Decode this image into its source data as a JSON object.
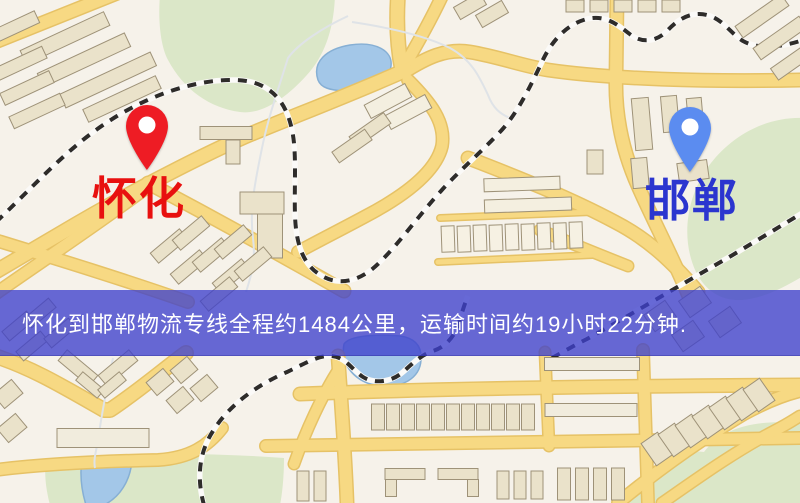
{
  "banner": {
    "text": "怀化到邯郸物流专线全程约1484公里，运输时间约19小时22分钟.",
    "bg": "rgba(62,64,204,0.78)",
    "text_color": "#ffffff"
  },
  "markers": {
    "huaihua": {
      "label": "怀化",
      "pin_color": "#ee1c24",
      "label_color": "#e8100f"
    },
    "handan": {
      "label": "邯郸",
      "pin_color": "#5b8cf0",
      "label_color": "#2b35cf"
    }
  },
  "map": {
    "palette": {
      "land": "#f6f2ea",
      "park": "#dbe7c8",
      "water": "#a3c7e8",
      "water_edge": "#86afd4",
      "creek": "#dfe3e7",
      "road": "#f7d983",
      "road_casing": "#e6c266",
      "rail_dark": "#2e2c2a",
      "rail_light": "#fbfaf8",
      "building": "#eae2ca",
      "building_edge": "#9e9278"
    },
    "parks": [
      {
        "d": "M160,-5 L335,-5 C334,28 325,56 306,76 C286,98 262,115 240,112 C210,108 184,90 168,60 C160,45 158,18 160,-5 Z"
      },
      {
        "d": "M805,118 C762,116 726,140 706,170 C686,200 681,240 696,272 C706,292 722,301 742,300 C766,298 786,286 805,275 Z"
      },
      {
        "d": "M46,461 C120,452 200,452 284,458 C284,478 282,495 280,505 L50,505 C46,490 44,474 46,461 Z"
      },
      {
        "d": "M628,505 C652,468 676,448 704,452 C722,428 756,418 805,424 L805,505 Z"
      }
    ],
    "waters": [
      {
        "d": "M318,80 C312,62 326,49 350,45 C376,41 393,51 391,66 C389,82 368,93 344,91 C330,90 321,88 318,80 Z"
      },
      {
        "d": "M344,344 C340,365 355,382 378,386 C402,389 420,378 421,360 C422,346 415,338 400,336 C380,334 350,335 344,344 Z"
      },
      {
        "d": "M82,458 L132,461 C130,481 120,497 104,505 L86,505 C81,489 80,472 82,458 Z"
      }
    ],
    "creeks": [
      {
        "d": "M348,16 C322,28 298,44 288,58 C278,90 268,118 262,148 C256,178 249,208 253,238 C256,262 251,276 246,292"
      },
      {
        "d": "M113,358 C108,382 102,412 99,434 C97,450 93,458 95,468"
      },
      {
        "d": "M352,22 C392,28 426,36 450,48 C472,60 480,78 488,95 C493,108 500,114 510,118"
      }
    ],
    "roads": [
      {
        "d": "M-5,42 L120,-8",
        "w": 12
      },
      {
        "d": "M398,-5 C396,25 398,50 402,70",
        "w": 13
      },
      {
        "d": "M402,70 C415,48 430,22 443,-6",
        "w": 11
      },
      {
        "d": "M404,72 C426,58 446,48 470,52 C500,57 522,66 548,70 C610,79 706,82 800,80",
        "w": 12
      },
      {
        "d": "M406,70 C352,94 294,116 246,136 C190,161 120,198 58,235 C36,248 14,261 -5,272",
        "w": 13
      },
      {
        "d": "M162,176 C112,214 54,253 -5,294",
        "w": 11
      },
      {
        "d": "M-5,240 C60,260 122,279 188,302",
        "w": 11
      },
      {
        "d": "M148,183 C212,217 274,251 344,291",
        "w": 12
      },
      {
        "d": "M408,80 C430,102 446,122 442,146 C436,172 404,196 366,216 C342,229 318,241 298,252",
        "w": 11
      },
      {
        "d": "M617,-5 L616,78 C615,114 622,150 638,186 C654,222 672,256 688,294",
        "w": 12
      },
      {
        "d": "M468,158 C520,178 570,198 615,222 C650,240 674,264 698,292",
        "w": 12
      },
      {
        "d": "M440,218 L592,212",
        "w": 5
      },
      {
        "d": "M438,262 L592,255",
        "w": 5
      },
      {
        "d": "M-5,356 C32,368 62,386 104,410 L110,410 C140,390 164,369 186,353",
        "w": 13
      },
      {
        "d": "M-5,470 C52,463 112,461 158,460 C190,458 208,446 222,428",
        "w": 11
      },
      {
        "d": "M338,356 C341,400 345,450 347,503",
        "w": 12
      },
      {
        "d": "M300,394 C430,389 610,386 800,385",
        "w": 12
      },
      {
        "d": "M266,446 C440,442 620,440 800,438",
        "w": 11
      },
      {
        "d": "M643,350 L648,503",
        "w": 11
      },
      {
        "d": "M545,352 L549,446",
        "w": 10
      },
      {
        "d": "M618,503 C658,470 700,440 744,414 C764,403 784,395 800,391",
        "w": 11
      },
      {
        "d": "M662,503 C698,478 734,452 774,431 C788,424 795,419 800,416",
        "w": 10
      },
      {
        "d": "M337,372 C322,396 306,430 294,464",
        "w": 10
      },
      {
        "d": "M540,230 C570,243 600,255 628,266",
        "w": 10
      }
    ],
    "railways": [
      {
        "d": "M-4,222 C28,192 60,156 96,130 C140,98 192,79 236,80 C270,81 286,101 292,130 C297,152 294,188 295,215 C296,246 304,266 322,276 C341,287 363,280 381,261 C401,241 420,214 441,191 C459,171 479,154 498,134 C516,116 529,89 541,64 C551,41 567,24 587,19 C607,14 620,27 631,35 C643,44 658,41 668,30 C678,19 692,11 707,15 C723,19 730,33 743,41 C757,49 778,48 800,41"
      },
      {
        "d": "M552,358 C563,352 575,345 587,339 C632,314 682,284 731,256 C756,241 779,227 804,212"
      },
      {
        "d": "M204,505 C197,480 198,454 213,431 C229,405 257,385 287,372 C306,363 319,355 331,356 C346,357 352,370 363,377 C376,385 393,381 403,372 C413,363 421,355 433,351 C445,347 453,338 458,326 C461,316 464,305 468,296"
      }
    ],
    "buildings": [
      {
        "cx": 65,
        "cy": 38,
        "w": 92,
        "h": 15,
        "r": -25
      },
      {
        "cx": 84,
        "cy": 60,
        "w": 96,
        "h": 15,
        "r": -25
      },
      {
        "cx": 108,
        "cy": 80,
        "w": 100,
        "h": 15,
        "r": -25
      },
      {
        "cx": 122,
        "cy": 99,
        "w": 80,
        "h": 14,
        "r": -25
      },
      {
        "cx": 19,
        "cy": 64,
        "w": 56,
        "h": 13,
        "r": -25
      },
      {
        "cx": 27,
        "cy": 88,
        "w": 54,
        "h": 13,
        "r": -25
      },
      {
        "cx": 37,
        "cy": 111,
        "w": 56,
        "h": 13,
        "r": -25
      },
      {
        "cx": 17,
        "cy": 26,
        "w": 44,
        "h": 13,
        "r": -25
      },
      {
        "cx": 226,
        "cy": 133,
        "w": 52,
        "h": 13,
        "r": 0
      },
      {
        "cx": 233,
        "cy": 152,
        "w": 14,
        "h": 24,
        "r": 0
      },
      {
        "cx": 262,
        "cy": 203,
        "w": 44,
        "h": 22,
        "r": 0
      },
      {
        "cx": 270,
        "cy": 236,
        "w": 25,
        "h": 44,
        "r": 0
      },
      {
        "cx": 169,
        "cy": 246,
        "w": 38,
        "h": 13,
        "r": -40
      },
      {
        "cx": 191,
        "cy": 233,
        "w": 38,
        "h": 13,
        "r": -40
      },
      {
        "cx": 189,
        "cy": 267,
        "w": 38,
        "h": 13,
        "r": -40
      },
      {
        "cx": 211,
        "cy": 255,
        "w": 38,
        "h": 13,
        "r": -40
      },
      {
        "cx": 233,
        "cy": 242,
        "w": 38,
        "h": 13,
        "r": -40
      },
      {
        "cx": 231,
        "cy": 276,
        "w": 38,
        "h": 13,
        "r": -40
      },
      {
        "cx": 253,
        "cy": 264,
        "w": 38,
        "h": 13,
        "r": -40
      },
      {
        "cx": 219,
        "cy": 294,
        "w": 38,
        "h": 13,
        "r": -40
      },
      {
        "cx": 388,
        "cy": 101,
        "w": 46,
        "h": 15,
        "r": -28,
        "f": "#f4efe0"
      },
      {
        "cx": 408,
        "cy": 112,
        "w": 46,
        "h": 15,
        "r": -28,
        "f": "#f4efe0"
      },
      {
        "cx": 370,
        "cy": 130,
        "w": 42,
        "h": 13,
        "r": -35
      },
      {
        "cx": 352,
        "cy": 146,
        "w": 40,
        "h": 13,
        "r": -35
      },
      {
        "cx": 470,
        "cy": 6,
        "w": 30,
        "h": 14,
        "r": -30
      },
      {
        "cx": 492,
        "cy": 14,
        "w": 30,
        "h": 14,
        "r": -30
      },
      {
        "cx": 575,
        "cy": 6,
        "w": 18,
        "h": 12,
        "r": 0
      },
      {
        "cx": 599,
        "cy": 6,
        "w": 18,
        "h": 12,
        "r": 0
      },
      {
        "cx": 623,
        "cy": 6,
        "w": 18,
        "h": 12,
        "r": 0
      },
      {
        "cx": 647,
        "cy": 6,
        "w": 18,
        "h": 12,
        "r": 0
      },
      {
        "cx": 671,
        "cy": 6,
        "w": 18,
        "h": 12,
        "r": 0
      },
      {
        "cx": 762,
        "cy": 16,
        "w": 56,
        "h": 14,
        "r": -35
      },
      {
        "cx": 780,
        "cy": 38,
        "w": 56,
        "h": 14,
        "r": -35
      },
      {
        "cx": 795,
        "cy": 60,
        "w": 50,
        "h": 14,
        "r": -35
      },
      {
        "cx": 642,
        "cy": 124,
        "w": 17,
        "h": 52,
        "r": -5
      },
      {
        "cx": 670,
        "cy": 114,
        "w": 16,
        "h": 36,
        "r": -5
      },
      {
        "cx": 695,
        "cy": 113,
        "w": 15,
        "h": 30,
        "r": -5
      },
      {
        "cx": 693,
        "cy": 171,
        "w": 30,
        "h": 19,
        "r": -8
      },
      {
        "cx": 640,
        "cy": 173,
        "w": 16,
        "h": 30,
        "r": -5
      },
      {
        "cx": 595,
        "cy": 162,
        "w": 16,
        "h": 24,
        "r": 0
      },
      {
        "cx": 522,
        "cy": 184,
        "w": 76,
        "h": 13,
        "r": -2,
        "f": "#f4efe0"
      },
      {
        "cx": 528,
        "cy": 205,
        "w": 87,
        "h": 13,
        "r": -2,
        "f": "#f4efe0"
      },
      {
        "cx": 448,
        "cy": 239,
        "w": 13,
        "h": 26,
        "r": -2,
        "f": "#f6f1e3"
      },
      {
        "cx": 464,
        "cy": 239,
        "w": 13,
        "h": 26,
        "r": -2,
        "f": "#f6f1e3"
      },
      {
        "cx": 480,
        "cy": 238,
        "w": 13,
        "h": 26,
        "r": -2,
        "f": "#f6f1e3"
      },
      {
        "cx": 496,
        "cy": 238,
        "w": 13,
        "h": 26,
        "r": -2,
        "f": "#f6f1e3"
      },
      {
        "cx": 512,
        "cy": 237,
        "w": 13,
        "h": 26,
        "r": -2,
        "f": "#f6f1e3"
      },
      {
        "cx": 528,
        "cy": 237,
        "w": 13,
        "h": 26,
        "r": -2,
        "f": "#f6f1e3"
      },
      {
        "cx": 544,
        "cy": 236,
        "w": 13,
        "h": 26,
        "r": -2,
        "f": "#f6f1e3"
      },
      {
        "cx": 560,
        "cy": 236,
        "w": 13,
        "h": 26,
        "r": -2,
        "f": "#f6f1e3"
      },
      {
        "cx": 576,
        "cy": 235,
        "w": 13,
        "h": 26,
        "r": -2,
        "f": "#f6f1e3"
      },
      {
        "cx": 660,
        "cy": 316,
        "w": 26,
        "h": 20,
        "r": -35
      },
      {
        "cx": 695,
        "cy": 302,
        "w": 26,
        "h": 20,
        "r": -35
      },
      {
        "cx": 688,
        "cy": 336,
        "w": 26,
        "h": 20,
        "r": -35
      },
      {
        "cx": 725,
        "cy": 322,
        "w": 26,
        "h": 20,
        "r": -35
      },
      {
        "cx": 18,
        "cy": 326,
        "w": 32,
        "h": 12,
        "r": -40
      },
      {
        "cx": 40,
        "cy": 313,
        "w": 32,
        "h": 12,
        "r": -40
      },
      {
        "cx": 32,
        "cy": 346,
        "w": 32,
        "h": 12,
        "r": -40
      },
      {
        "cx": 60,
        "cy": 333,
        "w": 32,
        "h": 12,
        "r": -40
      },
      {
        "cx": 78,
        "cy": 368,
        "w": 40,
        "h": 14,
        "r": 40
      },
      {
        "cx": 118,
        "cy": 368,
        "w": 40,
        "h": 14,
        "r": -40
      },
      {
        "cx": 90,
        "cy": 385,
        "w": 28,
        "h": 11,
        "r": 40
      },
      {
        "cx": 112,
        "cy": 385,
        "w": 28,
        "h": 11,
        "r": -40
      },
      {
        "cx": 8,
        "cy": 394,
        "w": 24,
        "h": 18,
        "r": -40
      },
      {
        "cx": 12,
        "cy": 428,
        "w": 24,
        "h": 18,
        "r": -40
      },
      {
        "cx": 160,
        "cy": 382,
        "w": 22,
        "h": 17,
        "r": -40
      },
      {
        "cx": 184,
        "cy": 370,
        "w": 22,
        "h": 17,
        "r": -40
      },
      {
        "cx": 180,
        "cy": 400,
        "w": 22,
        "h": 17,
        "r": -40
      },
      {
        "cx": 204,
        "cy": 388,
        "w": 22,
        "h": 17,
        "r": -40
      },
      {
        "cx": 103,
        "cy": 438,
        "w": 92,
        "h": 19,
        "r": 0,
        "f": "#f1ecdd"
      },
      {
        "cx": 378,
        "cy": 417,
        "w": 13,
        "h": 26,
        "r": 0
      },
      {
        "cx": 393,
        "cy": 417,
        "w": 13,
        "h": 26,
        "r": 0
      },
      {
        "cx": 408,
        "cy": 417,
        "w": 13,
        "h": 26,
        "r": 0
      },
      {
        "cx": 423,
        "cy": 417,
        "w": 13,
        "h": 26,
        "r": 0
      },
      {
        "cx": 438,
        "cy": 417,
        "w": 13,
        "h": 26,
        "r": 0
      },
      {
        "cx": 453,
        "cy": 417,
        "w": 13,
        "h": 26,
        "r": 0
      },
      {
        "cx": 468,
        "cy": 417,
        "w": 13,
        "h": 26,
        "r": 0
      },
      {
        "cx": 483,
        "cy": 417,
        "w": 13,
        "h": 26,
        "r": 0
      },
      {
        "cx": 498,
        "cy": 417,
        "w": 13,
        "h": 26,
        "r": 0
      },
      {
        "cx": 513,
        "cy": 417,
        "w": 13,
        "h": 26,
        "r": 0
      },
      {
        "cx": 528,
        "cy": 417,
        "w": 13,
        "h": 26,
        "r": 0
      },
      {
        "cx": 405,
        "cy": 474,
        "w": 40,
        "h": 11,
        "r": 0
      },
      {
        "cx": 391,
        "cy": 488,
        "w": 11,
        "h": 17,
        "r": 0
      },
      {
        "cx": 458,
        "cy": 474,
        "w": 40,
        "h": 11,
        "r": 0
      },
      {
        "cx": 473,
        "cy": 488,
        "w": 11,
        "h": 17,
        "r": 0
      },
      {
        "cx": 303,
        "cy": 486,
        "w": 12,
        "h": 30,
        "r": 0
      },
      {
        "cx": 320,
        "cy": 486,
        "w": 12,
        "h": 30,
        "r": 0
      },
      {
        "cx": 503,
        "cy": 485,
        "w": 12,
        "h": 28,
        "r": 0
      },
      {
        "cx": 520,
        "cy": 485,
        "w": 12,
        "h": 28,
        "r": 0
      },
      {
        "cx": 537,
        "cy": 485,
        "w": 12,
        "h": 28,
        "r": 0
      },
      {
        "cx": 592,
        "cy": 364,
        "w": 95,
        "h": 13,
        "r": 0,
        "f": "#f1ecdd"
      },
      {
        "cx": 591,
        "cy": 410,
        "w": 92,
        "h": 13,
        "r": 0,
        "f": "#f1ecdd"
      },
      {
        "cx": 564,
        "cy": 484,
        "w": 13,
        "h": 32,
        "r": 0
      },
      {
        "cx": 582,
        "cy": 484,
        "w": 13,
        "h": 32,
        "r": 0
      },
      {
        "cx": 600,
        "cy": 484,
        "w": 13,
        "h": 32,
        "r": 0
      },
      {
        "cx": 618,
        "cy": 484,
        "w": 13,
        "h": 32,
        "r": 0
      },
      {
        "cx": 657,
        "cy": 449,
        "w": 20,
        "h": 27,
        "r": -35
      },
      {
        "cx": 674,
        "cy": 440,
        "w": 20,
        "h": 27,
        "r": -35
      },
      {
        "cx": 691,
        "cy": 431,
        "w": 20,
        "h": 27,
        "r": -35
      },
      {
        "cx": 708,
        "cy": 422,
        "w": 20,
        "h": 27,
        "r": -35
      },
      {
        "cx": 725,
        "cy": 413,
        "w": 20,
        "h": 27,
        "r": -35
      },
      {
        "cx": 742,
        "cy": 404,
        "w": 20,
        "h": 27,
        "r": -35
      },
      {
        "cx": 759,
        "cy": 395,
        "w": 20,
        "h": 27,
        "r": -35
      }
    ]
  }
}
